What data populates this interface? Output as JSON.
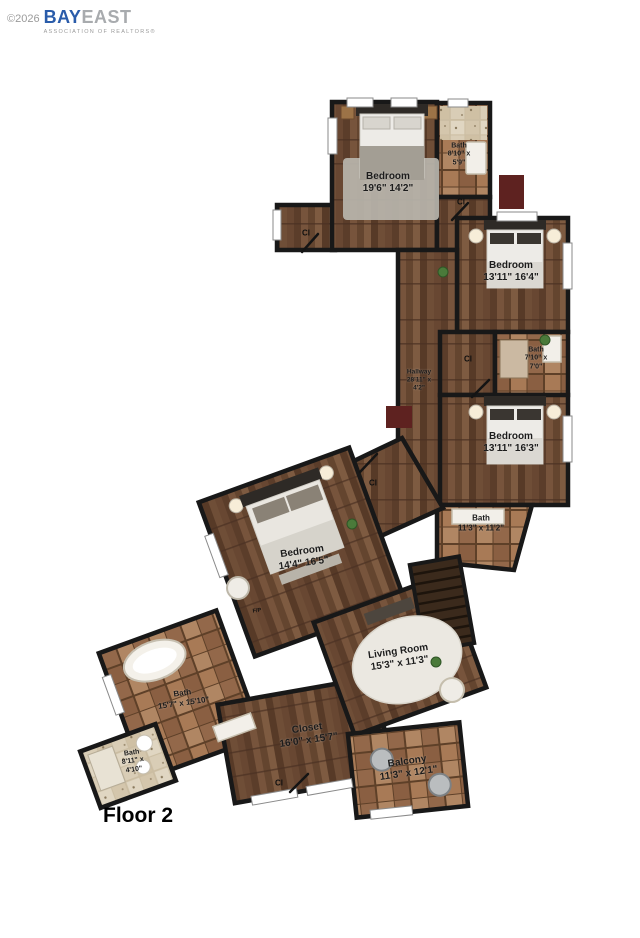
{
  "watermark": {
    "copyright": "©2026",
    "brand_primary": "BAY",
    "brand_secondary": "EAST",
    "tagline": "ASSOCIATION OF REALTORS®"
  },
  "floor_title": "Floor 2",
  "rooms": [
    {
      "name": "Bedroom",
      "dims": "19'6\" 14'2\""
    },
    {
      "name": "Bath",
      "dims": "8'10\" x",
      "dims2": "5'9\""
    },
    {
      "name": "Bedroom",
      "dims": "13'11\" 16'4\""
    },
    {
      "name": "Bath",
      "dims": "7'10\" x",
      "dims2": "7'0\""
    },
    {
      "name": "Hallway",
      "dims": "28'11\" x",
      "dims2": "4'2\""
    },
    {
      "name": "Bedroom",
      "dims": "13'11\" 16'3\""
    },
    {
      "name": "Bath",
      "dims": "11'3\" x 11'2\""
    },
    {
      "name": "Bedroom",
      "dims": "14'4\" 16'5\""
    },
    {
      "name": "Living Room",
      "dims": "15'3\" x 11'3\""
    },
    {
      "name": "Bath",
      "dims": "15'7\" x 15'10\""
    },
    {
      "name": "Bath",
      "dims": "8'11\" x",
      "dims2": "4'10\""
    },
    {
      "name": "Closet",
      "dims": "16'0\" x 15'7\""
    },
    {
      "name": "Balcony",
      "dims": "11'3\" x 12'1\""
    }
  ],
  "closet_markers": [
    "Cl",
    "Cl",
    "Cl",
    "Cl",
    "Cl"
  ],
  "fireplace_marker": "F/P",
  "colors": {
    "wood": "#6e4c35",
    "tile": "#a87a56",
    "wall": "#181818",
    "brand_blue": "#2a5caa",
    "brand_gray": "#a8abae"
  }
}
